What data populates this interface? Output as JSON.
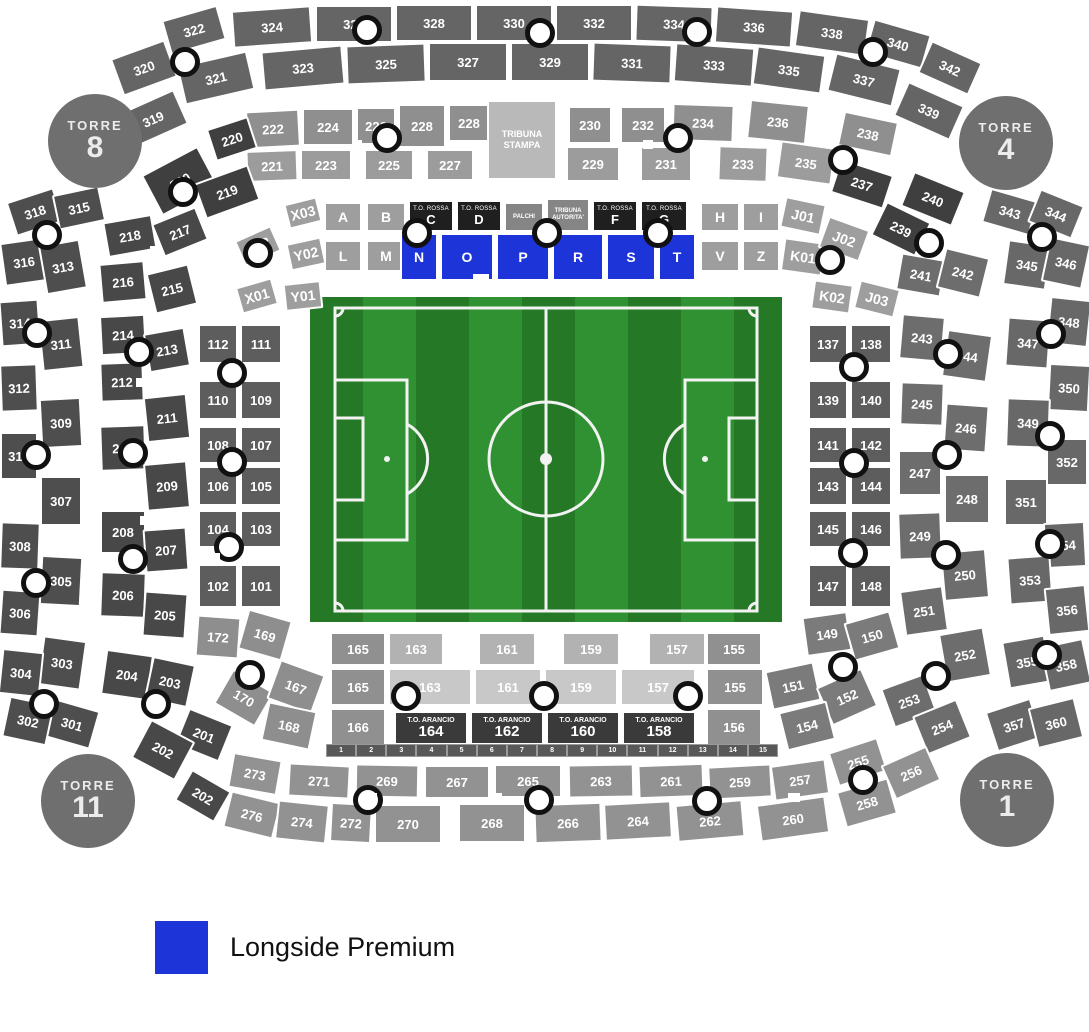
{
  "legend": {
    "label": "Longside Premium",
    "color": "#1d35d8"
  },
  "towers": [
    {
      "name": "TORRE",
      "number": "8"
    },
    {
      "name": "TORRE",
      "number": "4"
    },
    {
      "name": "TORRE",
      "number": "11"
    },
    {
      "name": "TORRE",
      "number": "1"
    }
  ],
  "special": {
    "tribuna_stampa": "TRIBUNA STAMPA",
    "palchi": "PALCHI",
    "tribuna_autorita": "TRIBUNA AUTORITA'",
    "to_rossa": "T.O. ROSSA",
    "to_arancio": "T.O. ARANCIO"
  },
  "strip_numbers": [
    "1",
    "2",
    "3",
    "4",
    "5",
    "6",
    "7",
    "8",
    "9",
    "10",
    "11",
    "12",
    "13",
    "14",
    "15"
  ],
  "sections": {
    "outer_top1": [
      "322",
      "324",
      "326",
      "328",
      "330",
      "332",
      "334",
      "336",
      "338",
      "340",
      "342"
    ],
    "outer_top2": [
      "320",
      "321",
      "323",
      "325",
      "327",
      "329",
      "331",
      "333",
      "335",
      "337",
      "319",
      "339"
    ],
    "second_top1": [
      "222",
      "224",
      "226",
      "228",
      "228",
      "230",
      "232",
      "234",
      "236",
      "238"
    ],
    "second_top2": [
      "221",
      "223",
      "225",
      "227",
      "229",
      "231",
      "233",
      "235"
    ],
    "corner_tl": [
      "220",
      "220",
      "219"
    ],
    "corner_tr": [
      "237",
      "240",
      "239"
    ],
    "outer_left": [
      "318",
      "315",
      "316",
      "313",
      "314",
      "311",
      "312",
      "309",
      "310",
      "307",
      "308",
      "305",
      "306",
      "303",
      "304",
      "301",
      "302"
    ],
    "second_left": [
      "218",
      "217",
      "216",
      "215",
      "214",
      "213",
      "212",
      "211",
      "210",
      "209",
      "208",
      "207",
      "206",
      "205",
      "204",
      "203",
      "201",
      "202",
      "202"
    ],
    "outer_right": [
      "343",
      "344",
      "345",
      "346",
      "348",
      "347",
      "350",
      "349",
      "352",
      "351",
      "354",
      "353",
      "356",
      "355",
      "358",
      "357",
      "360"
    ],
    "second_right": [
      "241",
      "242",
      "243",
      "244",
      "245",
      "246",
      "247",
      "248",
      "249",
      "250",
      "251",
      "252",
      "253",
      "254"
    ],
    "inner_left": [
      "112",
      "111",
      "110",
      "109",
      "108",
      "107",
      "106",
      "105",
      "104",
      "103",
      "102",
      "101"
    ],
    "inner_right": [
      "137",
      "138",
      "139",
      "140",
      "141",
      "142",
      "143",
      "144",
      "145",
      "146",
      "147",
      "148"
    ],
    "letters_gray": [
      "X03",
      "A",
      "B",
      "H",
      "I",
      "J01",
      "X02",
      "Y02",
      "L",
      "M",
      "V",
      "Z",
      "K01",
      "J02",
      "K02",
      "J03",
      "X01",
      "Y01"
    ],
    "black_letters": [
      "C",
      "D",
      "F",
      "G"
    ],
    "blue_letters": [
      "N",
      "O",
      "P",
      "R",
      "S",
      "T"
    ],
    "bottom_top_row": [
      "163",
      "161",
      "159",
      "157"
    ],
    "bottom_mid_light": [
      "163",
      "161",
      "159",
      "157"
    ],
    "bottom_dark_col": [
      "165",
      "165",
      "166",
      "155",
      "155",
      "156"
    ],
    "to_arancio_nums": [
      "164",
      "162",
      "160",
      "158"
    ],
    "inner_bottom_left": [
      "172",
      "169",
      "170",
      "167",
      "168"
    ],
    "inner_bottom_right": [
      "149",
      "150",
      "151",
      "152",
      "154"
    ],
    "bottom_row1": [
      "273",
      "271",
      "269",
      "267",
      "265",
      "263",
      "261",
      "259",
      "257",
      "255"
    ],
    "bottom_row2": [
      "276",
      "274",
      "272",
      "270",
      "268",
      "266",
      "264",
      "262",
      "260",
      "258",
      "256"
    ]
  }
}
